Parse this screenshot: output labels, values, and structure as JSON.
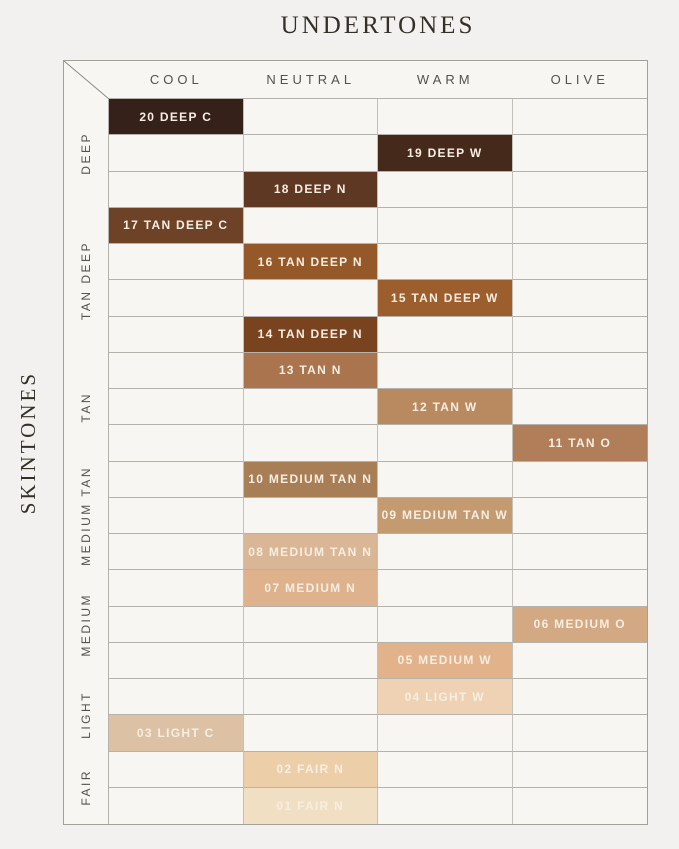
{
  "title": "UNDERTONES",
  "side_title": "SKINTONES",
  "palette": {
    "page_background": "#f2f1ef",
    "empty_cell": "#f7f6f3",
    "grid_line": "#b5b1ab",
    "title_text": "#343028",
    "header_text": "#55514b",
    "swatch_text": "#f6eee1"
  },
  "chart_data": {
    "type": "heatmap",
    "title": "UNDERTONES",
    "xlabel": "UNDERTONES",
    "ylabel": "SKINTONES",
    "columns": [
      "COOL",
      "NEUTRAL",
      "WARM",
      "OLIVE"
    ],
    "row_groups": [
      {
        "label": "DEEP",
        "span": 3
      },
      {
        "label": "TAN DEEP",
        "span": 4
      },
      {
        "label": "TAN",
        "span": 3
      },
      {
        "label": "MEDIUM TAN",
        "span": 3
      },
      {
        "label": "MEDIUM",
        "span": 3
      },
      {
        "label": "LIGHT",
        "span": 2
      },
      {
        "label": "FAIR",
        "span": 2
      }
    ],
    "rows": [
      {
        "shade": "20 DEEP C",
        "undertone": "COOL",
        "skintone": "DEEP",
        "color": "#35211a"
      },
      {
        "shade": "19 DEEP W",
        "undertone": "WARM",
        "skintone": "DEEP",
        "color": "#452a1b"
      },
      {
        "shade": "18 DEEP N",
        "undertone": "NEUTRAL",
        "skintone": "DEEP",
        "color": "#5f3823"
      },
      {
        "shade": "17 TAN DEEP C",
        "undertone": "COOL",
        "skintone": "TAN DEEP",
        "color": "#6e4227"
      },
      {
        "shade": "16 TAN DEEP N",
        "undertone": "NEUTRAL",
        "skintone": "TAN DEEP",
        "color": "#945829"
      },
      {
        "shade": "15 TAN DEEP W",
        "undertone": "WARM",
        "skintone": "TAN DEEP",
        "color": "#9d5e2e"
      },
      {
        "shade": "14 TAN DEEP N",
        "undertone": "NEUTRAL",
        "skintone": "TAN DEEP",
        "color": "#7a431f"
      },
      {
        "shade": "13 TAN N",
        "undertone": "NEUTRAL",
        "skintone": "TAN",
        "color": "#a9744e"
      },
      {
        "shade": "12 TAN W",
        "undertone": "WARM",
        "skintone": "TAN",
        "color": "#b98a60"
      },
      {
        "shade": "11 TAN O",
        "undertone": "OLIVE",
        "skintone": "TAN",
        "color": "#b07e58"
      },
      {
        "shade": "10 MEDIUM TAN N",
        "undertone": "NEUTRAL",
        "skintone": "MEDIUM TAN",
        "color": "#a87e57"
      },
      {
        "shade": "09 MEDIUM TAN W",
        "undertone": "WARM",
        "skintone": "MEDIUM TAN",
        "color": "#c49a71"
      },
      {
        "shade": "08 MEDIUM TAN N",
        "undertone": "NEUTRAL",
        "skintone": "MEDIUM TAN",
        "color": "#d9b796"
      },
      {
        "shade": "07 MEDIUM N",
        "undertone": "NEUTRAL",
        "skintone": "MEDIUM",
        "color": "#deb28d"
      },
      {
        "shade": "06 MEDIUM O",
        "undertone": "OLIVE",
        "skintone": "MEDIUM",
        "color": "#d2a982"
      },
      {
        "shade": "05 MEDIUM W",
        "undertone": "WARM",
        "skintone": "MEDIUM",
        "color": "#e2b28b"
      },
      {
        "shade": "04 LIGHT W",
        "undertone": "WARM",
        "skintone": "LIGHT",
        "color": "#eed2b3"
      },
      {
        "shade": "03 LIGHT C",
        "undertone": "COOL",
        "skintone": "LIGHT",
        "color": "#dcc1a5"
      },
      {
        "shade": "02 FAIR N",
        "undertone": "NEUTRAL",
        "skintone": "FAIR",
        "color": "#eccfa9"
      },
      {
        "shade": "01 FAIR N",
        "undertone": "NEUTRAL",
        "skintone": "FAIR",
        "color": "#f1dfc3"
      }
    ]
  }
}
